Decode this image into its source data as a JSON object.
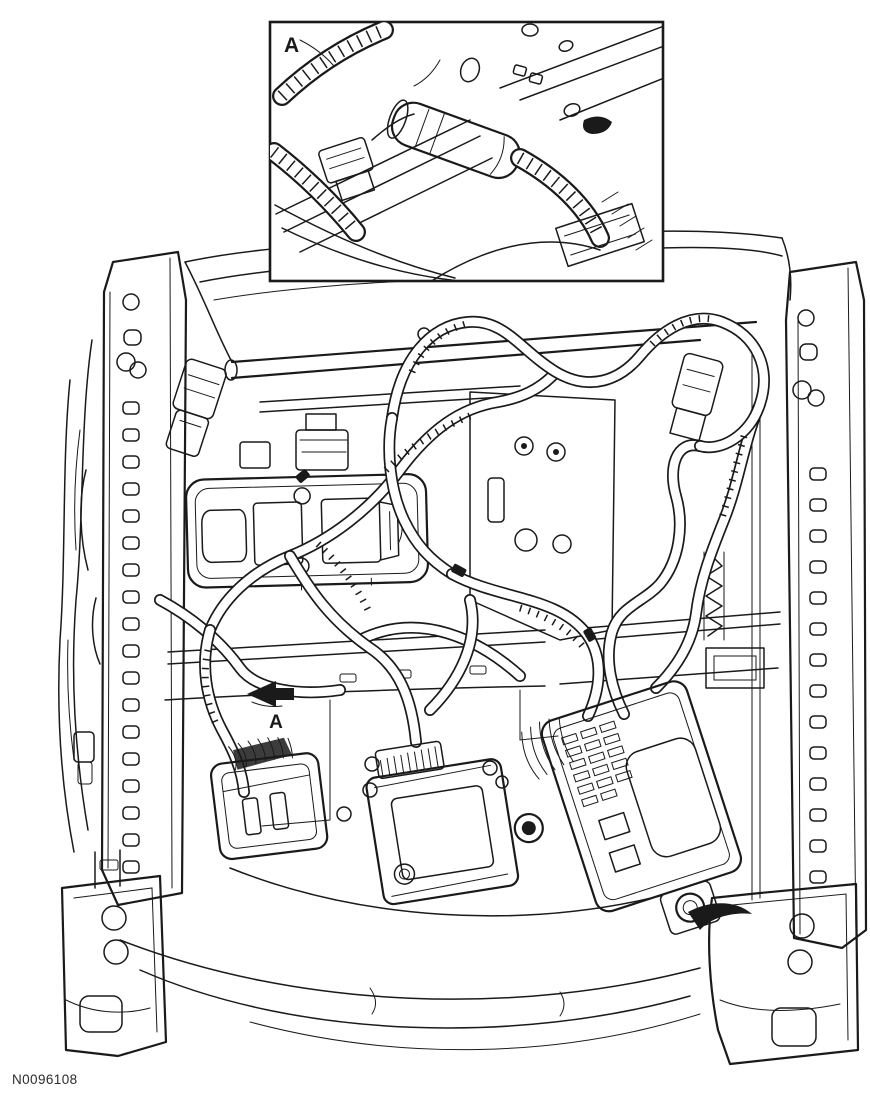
{
  "figure": {
    "inset_label": "A",
    "arrow_label": "A",
    "reference_number": "N0096108"
  },
  "colors": {
    "line": "#1a1a1a",
    "background": "#ffffff"
  }
}
